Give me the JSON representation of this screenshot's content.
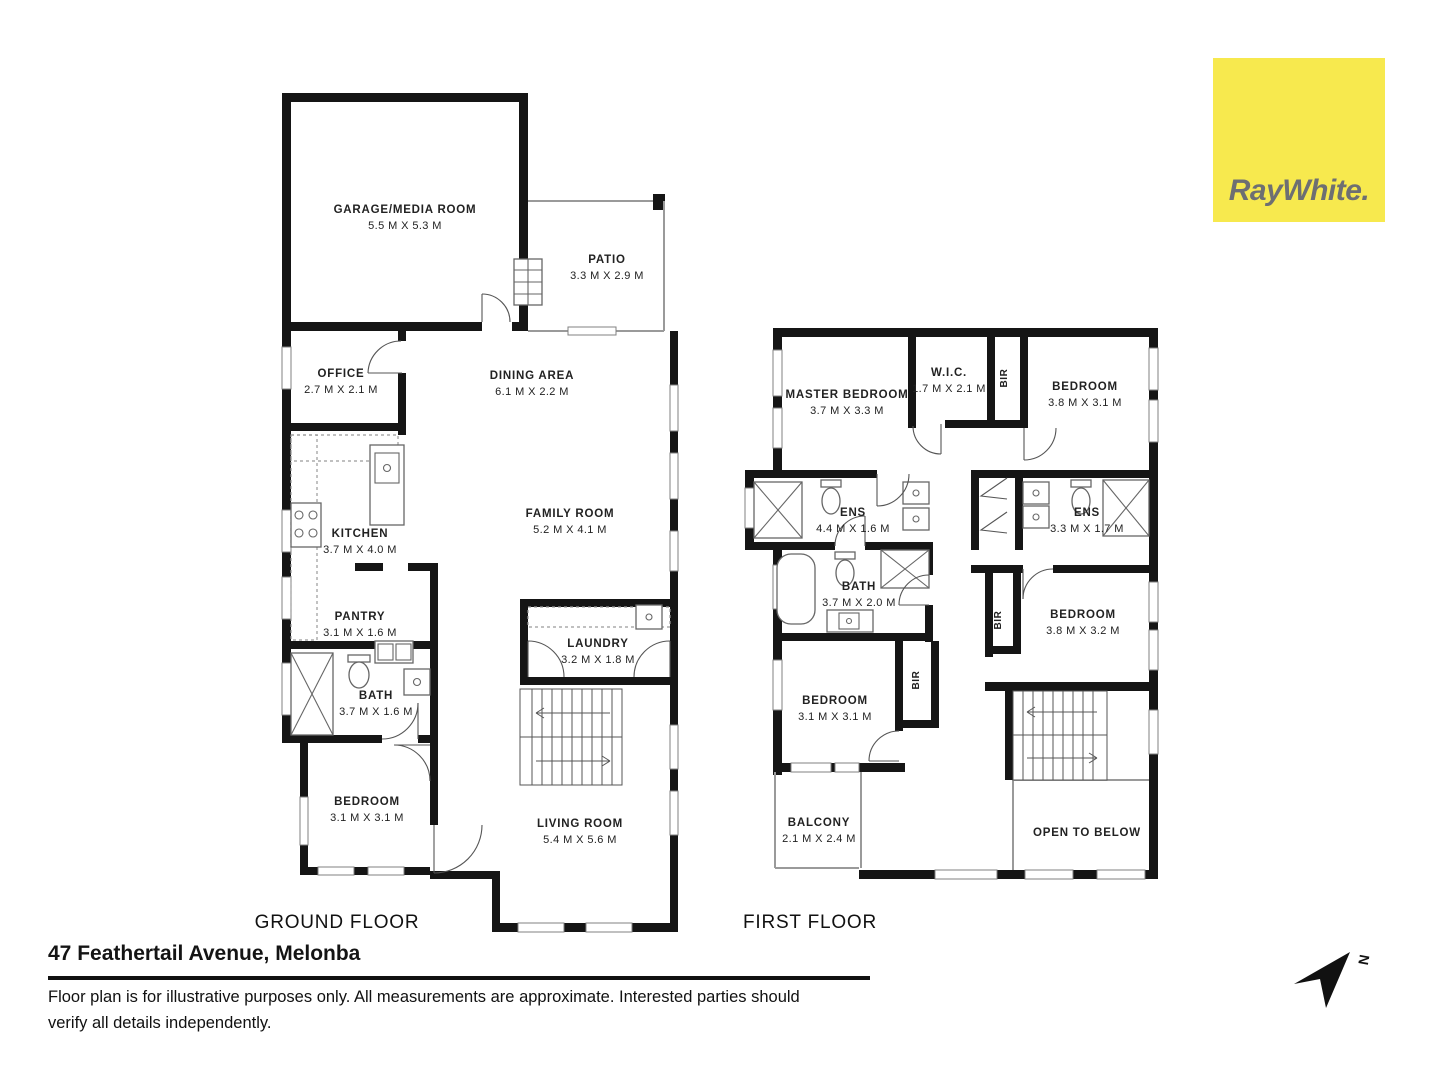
{
  "branding": {
    "logo_text": "RayWhite.",
    "logo_bg": "#F7E94E",
    "logo_text_color": "#6E6F72"
  },
  "floors": {
    "ground": {
      "label": "GROUND FLOOR",
      "rooms": {
        "garage": {
          "name": "GARAGE/MEDIA ROOM",
          "dims": "5.5 M X 5.3 M"
        },
        "patio": {
          "name": "PATIO",
          "dims": "3.3 M X 2.9 M"
        },
        "office": {
          "name": "OFFICE",
          "dims": "2.7 M X 2.1 M"
        },
        "dining": {
          "name": "DINING AREA",
          "dims": "6.1 M X 2.2 M"
        },
        "kitchen": {
          "name": "KITCHEN",
          "dims": "3.7 M X 4.0 M"
        },
        "family": {
          "name": "FAMILY ROOM",
          "dims": "5.2 M X 4.1 M"
        },
        "pantry": {
          "name": "PANTRY",
          "dims": "3.1 M X 1.6 M"
        },
        "laundry": {
          "name": "LAUNDRY",
          "dims": "3.2 M X 1.8 M"
        },
        "bath": {
          "name": "BATH",
          "dims": "3.7 M X 1.6 M"
        },
        "bedroom": {
          "name": "BEDROOM",
          "dims": "3.1 M X 3.1 M"
        },
        "living": {
          "name": "LIVING ROOM",
          "dims": "5.4 M X 5.6 M"
        }
      }
    },
    "first": {
      "label": "FIRST FLOOR",
      "bir_label": "BIR",
      "rooms": {
        "master": {
          "name": "MASTER BEDROOM",
          "dims": "3.7 M X 3.3 M"
        },
        "wic": {
          "name": "W.I.C.",
          "dims": "1.7 M X 2.1 M"
        },
        "bedroom_tr": {
          "name": "BEDROOM",
          "dims": "3.8 M X 3.1 M"
        },
        "ens_main": {
          "name": "ENS",
          "dims": "4.4 M X 1.6 M"
        },
        "ens_second": {
          "name": "ENS",
          "dims": "3.3 M X 1.7 M"
        },
        "bath": {
          "name": "BATH",
          "dims": "3.7 M X 2.0 M"
        },
        "bedroom_mid": {
          "name": "BEDROOM",
          "dims": "3.8 M X 3.2 M"
        },
        "bedroom_low": {
          "name": "BEDROOM",
          "dims": "3.1 M X 3.1 M"
        },
        "balcony": {
          "name": "BALCONY",
          "dims": "2.1 M X 2.4 M"
        },
        "open_below": {
          "name": "OPEN TO BELOW"
        }
      }
    }
  },
  "footer": {
    "address": "47 Feathertail Avenue, Melonba",
    "disclaimer_line1": "Floor plan is for illustrative purposes only. All measurements are approximate. Interested parties should",
    "disclaimer_line2": "verify all details independently.",
    "north_label": "N"
  }
}
